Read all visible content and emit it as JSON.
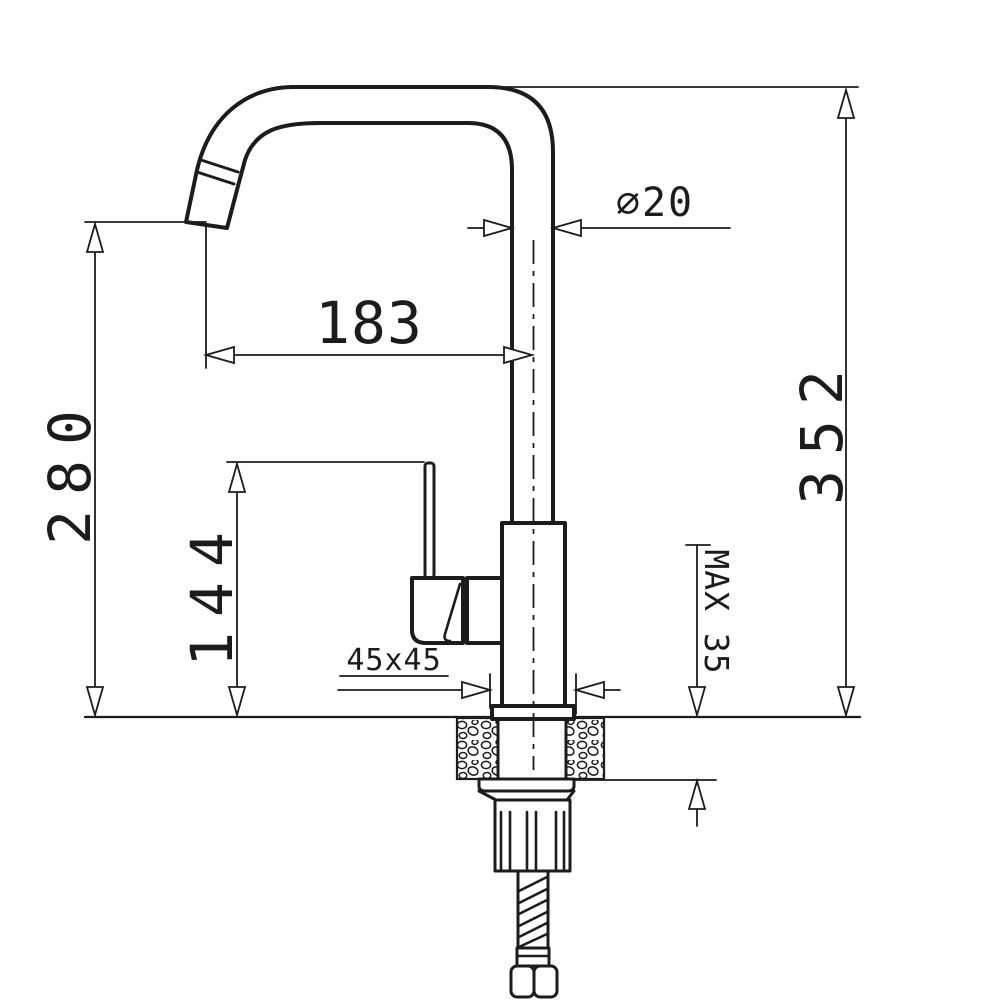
{
  "drawing": {
    "type": "technical-dimension-drawing",
    "subject": "kitchen mixer faucet side view with installation dimensions",
    "background": "#ffffff",
    "line_color": "#1c1c1c",
    "labels": {
      "spout_outlet_height": "280",
      "handle_top_height": "144",
      "spout_reach": "183",
      "overall_height": "352",
      "spout_tube_diameter": "⌀20",
      "body_cross_section": "45x45",
      "max_mounting_thickness": "MAX 35"
    }
  }
}
